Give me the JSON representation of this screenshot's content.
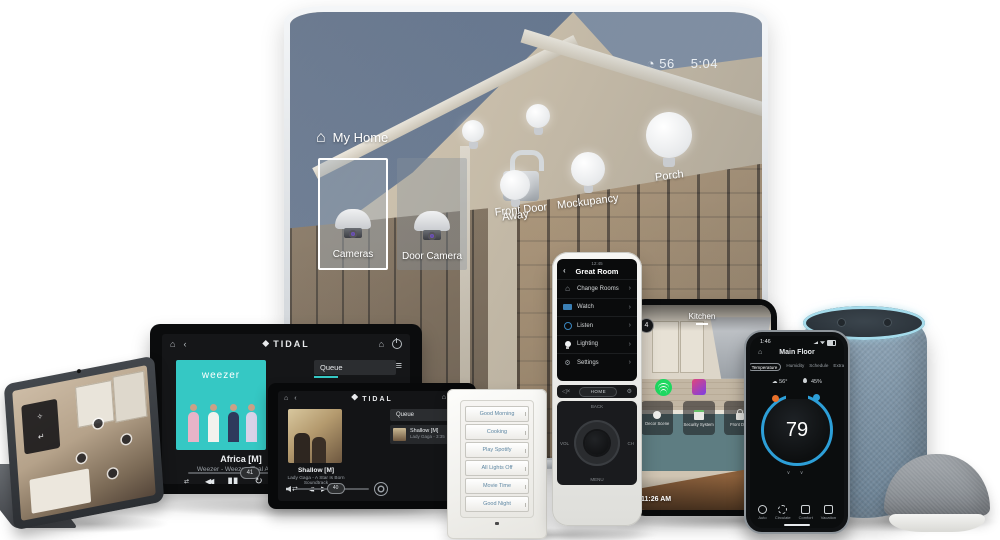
{
  "glyphs": {
    "home": "⌂",
    "back": "‹",
    "chev": "›",
    "menu": "≡",
    "shuffle": "⇄",
    "prev": "◀◀",
    "pause": "▮▮",
    "play": "▶",
    "repeat": "↻",
    "gear": "⚙",
    "cloud": "☁",
    "quad": "◔",
    "down": "∨ ∨"
  },
  "tv": {
    "status_temp": "56",
    "status_time": "5:04",
    "header_label": "My Home",
    "tile_cameras": "Cameras",
    "tile_door_camera": "Door Camera",
    "lock_label": "Front Door",
    "bulb_away": "Away",
    "bulb_mockupancy": "Mockupancy",
    "bulb_porch": "Porch"
  },
  "remote": {
    "screen_time": "12:45",
    "title": "Great Room",
    "menu": [
      {
        "label": "Change Rooms"
      },
      {
        "label": "Watch"
      },
      {
        "label": "Listen"
      },
      {
        "label": "Lighting"
      },
      {
        "label": "Settings"
      }
    ],
    "home_button": "HOME",
    "dpad_back": "BACK",
    "dpad_menu": "MENU",
    "dpad_vol": "VOL",
    "dpad_ch": "CH"
  },
  "tidal_large": {
    "brand": "TIDAL",
    "album_title": "weezer",
    "song": "Africa [M]",
    "artist": "Weezer - Weezer (Teal Album)",
    "queue_label": "Queue",
    "slider_value": "41"
  },
  "tidal_small": {
    "brand": "TIDAL",
    "queue_label": "Queue",
    "queue_song": "Shallow [M]",
    "queue_meta": "Lady Gaga - 3:35",
    "song": "Shallow [M]",
    "artist": "Lady Gaga - A Star Is Born Soundtrack",
    "volume_value": "40"
  },
  "keypad": {
    "buttons": [
      "Good Morning",
      "Cooking",
      "Play Spotify",
      "All Lights Off",
      "Movie Time",
      "Good Night"
    ]
  },
  "kitchen": {
    "logo": "4",
    "title": "Kitchen",
    "time": "11:26 AM",
    "shortcuts": [
      {
        "label": "Decor Scene"
      },
      {
        "label": "Security System"
      },
      {
        "label": "Front Door"
      }
    ]
  },
  "phone": {
    "status_time": "1:46",
    "title": "Main Floor",
    "tabs": [
      "Temperature",
      "Humidity",
      "Schedule",
      "Extras"
    ],
    "outdoor_temp": "56°",
    "humidity": "45%",
    "setpoint": "79",
    "nav": [
      "Auto",
      "Circulate",
      "Comfort",
      "Vacation"
    ]
  },
  "colors": {
    "tidal_teal": "#35c8c4",
    "dial_blue": "#2d9fd8",
    "heat_orange": "#e8702a",
    "spotify_green": "#1ed760",
    "keypad_text": "#5e87a3",
    "echo_ring": "#a5dcec"
  }
}
